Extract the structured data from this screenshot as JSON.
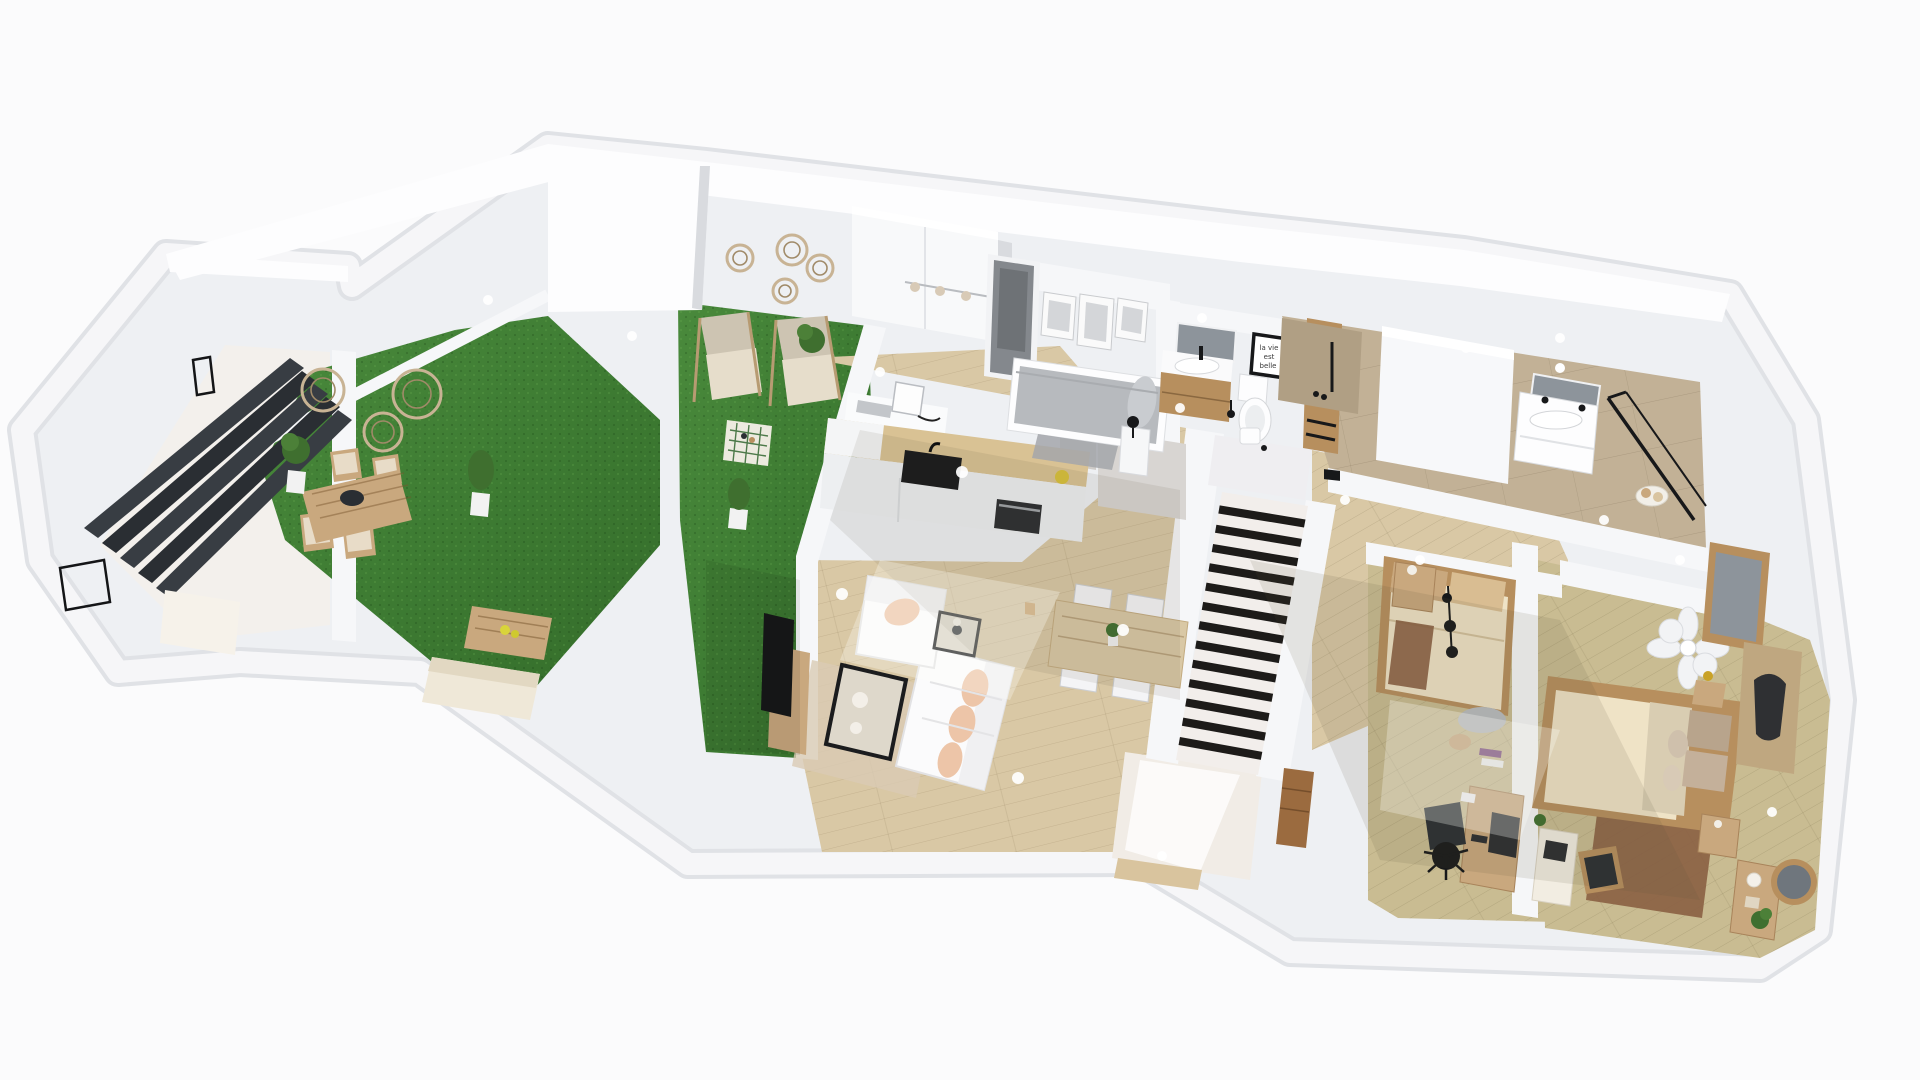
{
  "scene": {
    "title": "3D floor plan render — ground floor overview",
    "style": "isometric 3D view, white walls, wood floors, artificial grass terraces"
  },
  "sign": {
    "lines": [
      "la vie",
      "est",
      "belle"
    ]
  },
  "palette": {
    "wall": "#eef0f3",
    "wallBand": "#f6f7f9",
    "wallBright": "#fdfdfe",
    "wallShade": "#d9dbdf",
    "floorPale": "#f3f0ec",
    "wood": "#d9c8a5",
    "woodOlive": "#c9bc92",
    "grassA": "#478538",
    "grassB": "#35702b",
    "stone": "#c2b196",
    "stoneDark": "#b09f84",
    "charcoal": "#383d43",
    "charcoalDark": "#2a2e33",
    "stairWhite": "#f2eeeb",
    "stripe": "#1d1b19",
    "island": "#edeff1",
    "islandWoodTop": "#d9c294",
    "black": "#17181a",
    "appliance": "#2b2d30",
    "sofa": "#fbfbfc",
    "blush": "#edc5a8",
    "dayBed": "#b7babe",
    "dayBedLight": "#c9ccd0",
    "bedCream": "#efe3c6",
    "bedTan": "#c9a87e",
    "frameWood": "#b78f5e",
    "rugBrown": "#8a5f42",
    "rugGray": "#a3a6aa",
    "rugBeige": "#d9cbb4",
    "mirror": "#8d949b",
    "gold": "#c9a227",
    "plant": "#3f6f2f",
    "doorGray": "#84888d",
    "mat": "#9b6b3f",
    "entry": "#f1ece6",
    "rattan": "#c8b394",
    "rattanDark": "#a08a68"
  },
  "rooms": [
    {
      "name": "Basement stairs room",
      "items": [
        "dark staircase",
        "black stair railings",
        "pale landing"
      ]
    },
    {
      "name": "Dining terrace",
      "items": [
        "artificial grass",
        "outdoor dining table",
        "4 outdoor chairs",
        "black serving bowl",
        "potted shrub",
        "potted shrub",
        "rattan wall discs",
        "wooden coffee table with lemons",
        "cream sun lounger"
      ]
    },
    {
      "name": "Lounge terrace",
      "items": [
        "artificial grass",
        "lounge chair",
        "lounge chair",
        "woven side table",
        "potted plant",
        "potted plant",
        "rattan wall discs"
      ]
    },
    {
      "name": "Kitchen",
      "items": [
        "island with black sink",
        "built-in oven",
        "fruit bowl",
        "tall white cabinets",
        "desk with monitor",
        "multi-bulb ceiling light"
      ]
    },
    {
      "name": "Living room",
      "items": [
        "white sofa with blush cushions",
        "white armchair",
        "black glass coffee table",
        "black side table with lamp",
        "TV on wooden console",
        "beige rug"
      ]
    },
    {
      "name": "Dining area",
      "items": [
        "wooden dining table",
        "4 white chairs",
        "table plant",
        "gray wall stubs"
      ]
    },
    {
      "name": "Guest bedroom",
      "items": [
        "gray daybed",
        "gray rug",
        "white nightstand",
        "black table lamp",
        "three gallery frames",
        "gray door",
        "white wardrobe"
      ]
    },
    {
      "name": "Bathroom",
      "items": [
        "wood vanity with white sink",
        "mirror",
        "wall light",
        "toilet",
        "toilet brush",
        "black typography sign"
      ]
    },
    {
      "name": "Staircase and entry",
      "items": [
        "striped stair runner",
        "white landing",
        "white bin",
        "wood panel with hooks",
        "entry floor",
        "brown doormat",
        "door sill"
      ]
    },
    {
      "name": "Master bathroom",
      "items": [
        "stone tiled floor",
        "black framed walk-in shower",
        "black shower head",
        "white partition closet",
        "white vanity with sink",
        "mirror",
        "towel basket"
      ]
    },
    {
      "name": "Guest bedroom office",
      "items": [
        "single bed with cream duvet",
        "tan pillows",
        "black hanging pendant",
        "wood nightstand",
        "brown rug",
        "laundry pile",
        "laundry basket",
        "magazine stack",
        "desk with monitor",
        "black office chair"
      ]
    },
    {
      "name": "Master bedroom",
      "items": [
        "double bed with cream duvet",
        "taupe pillows",
        "flower pendant light",
        "framed wall mirror",
        "dark abstract artwork",
        "headboard nightstand with gold lamp",
        "wood nightstand",
        "brown rug",
        "console table with plant and candle",
        "round wall mirror",
        "laptop desk",
        "desk chair",
        "small plant"
      ]
    }
  ]
}
